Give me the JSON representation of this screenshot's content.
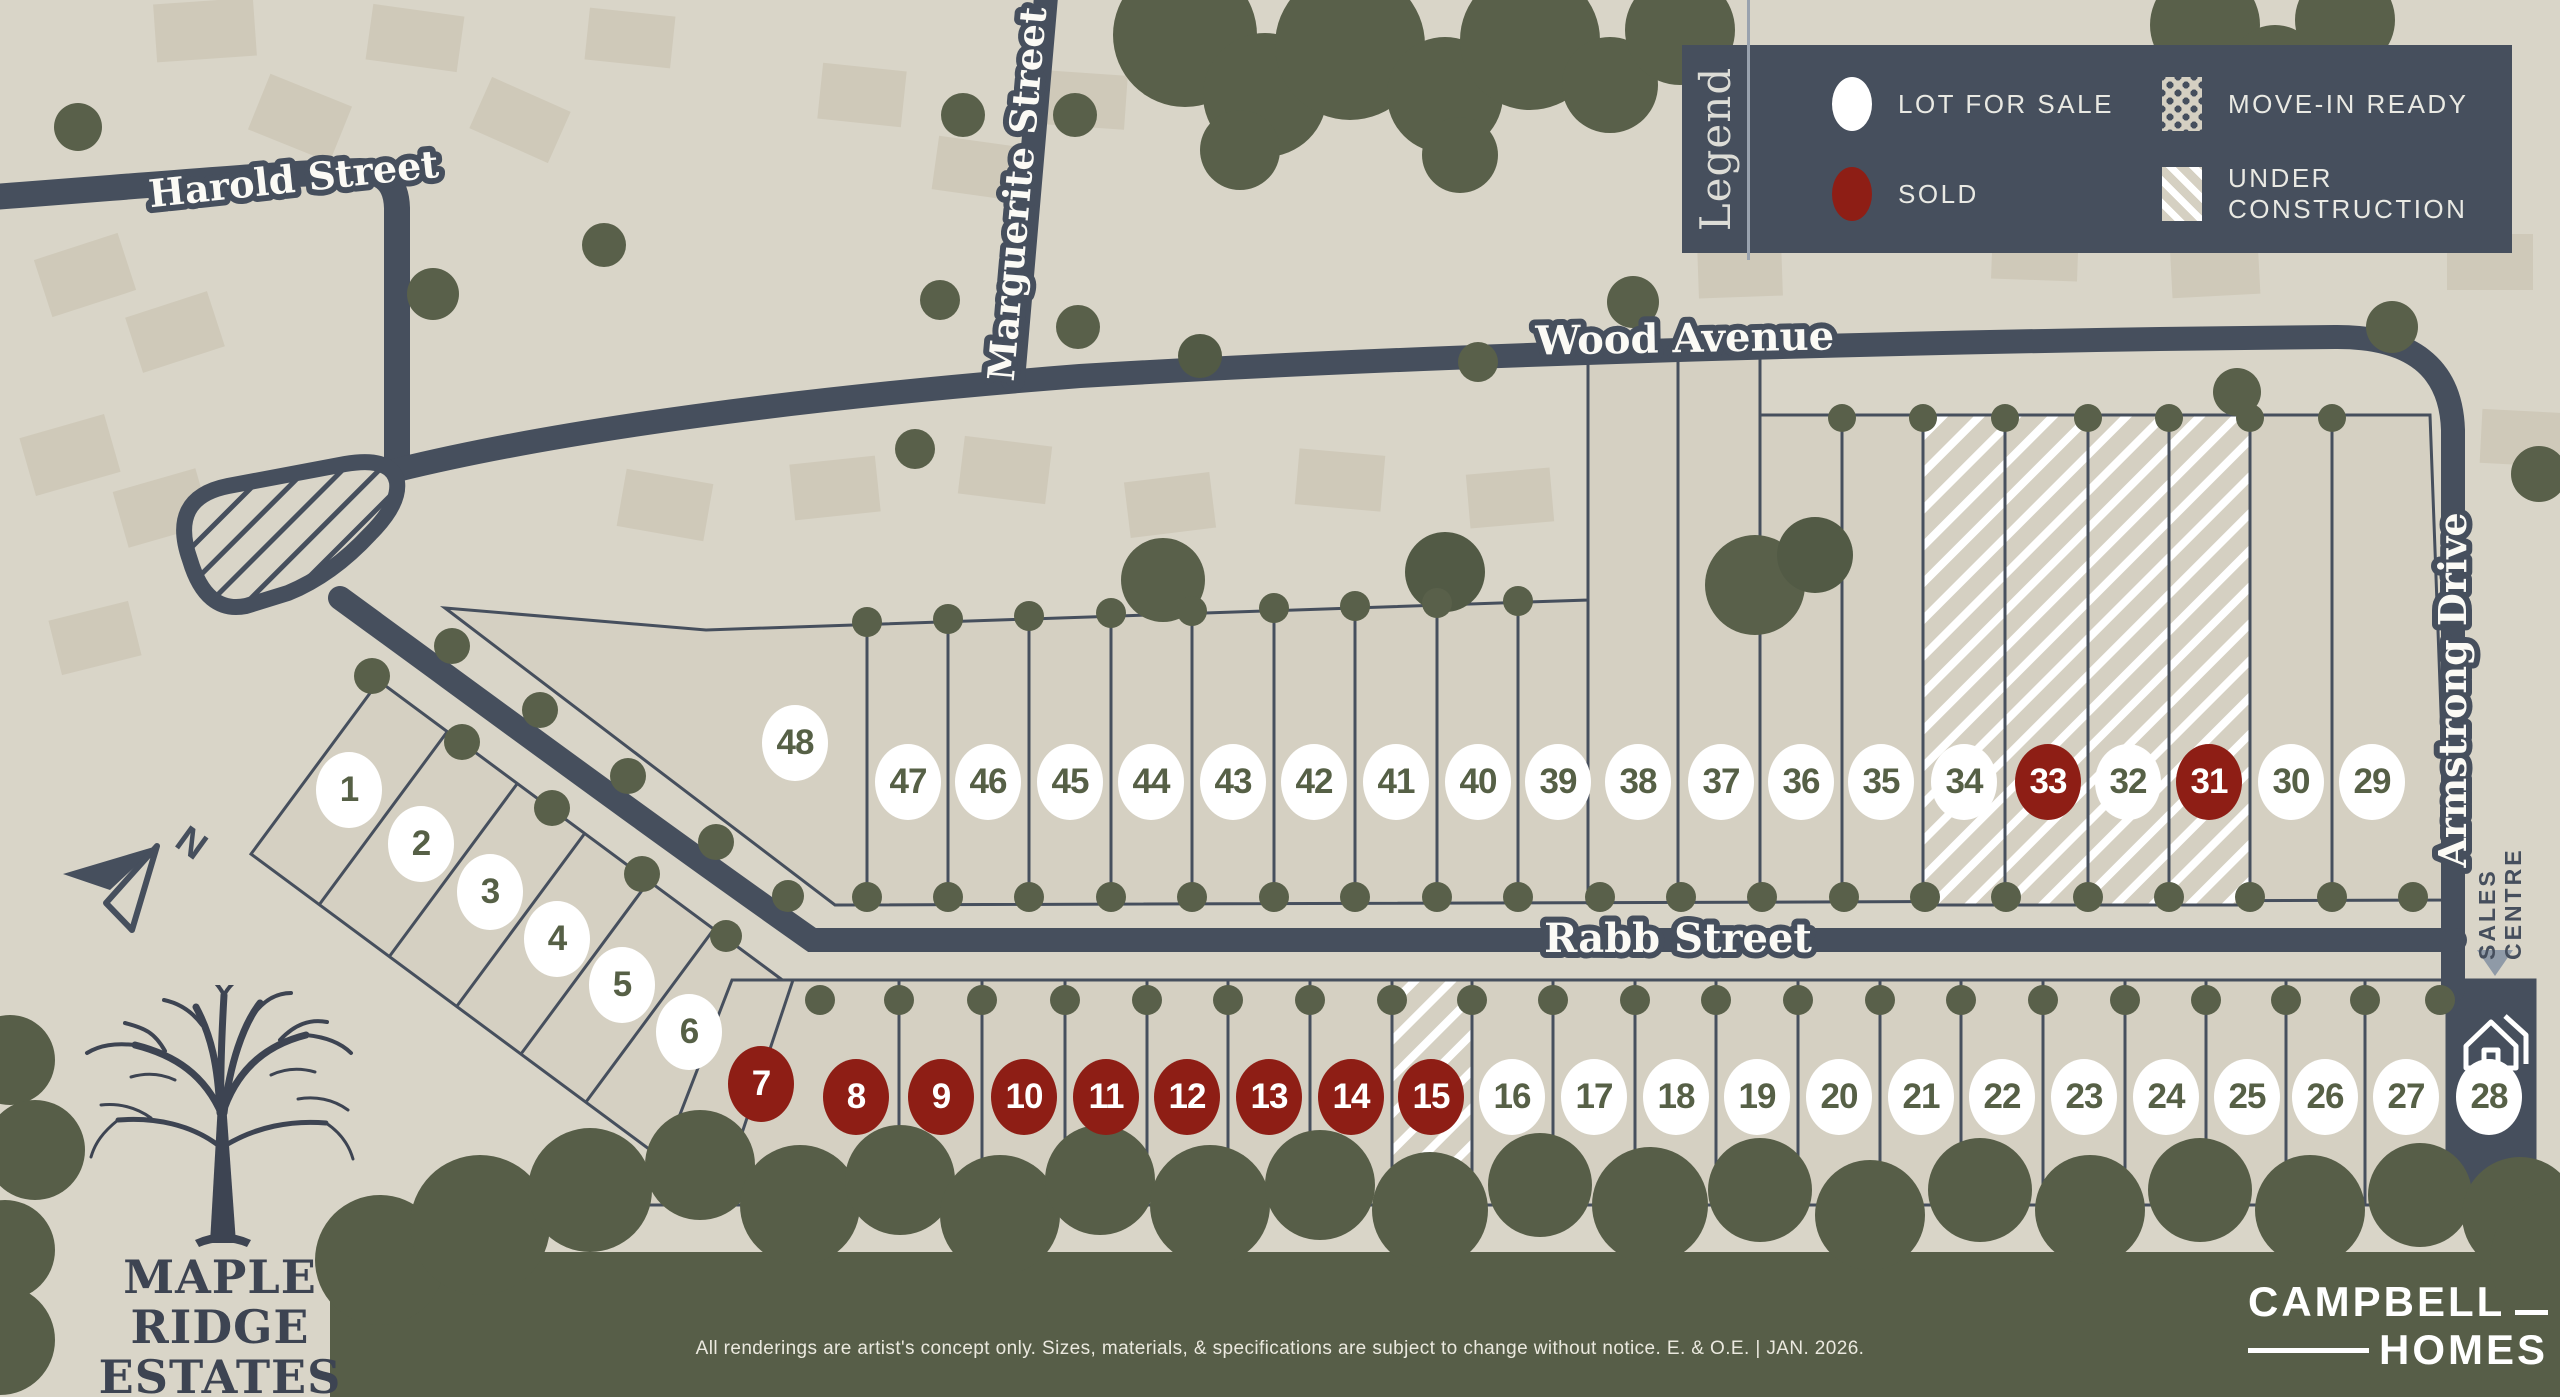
{
  "colors": {
    "road": "#464f5d",
    "sold": "#8e1e15",
    "tree": "#59604a",
    "parcel": "#d5d0c2",
    "background": "#d9d5c8"
  },
  "legend": {
    "title": "Legend",
    "items": [
      {
        "label": "LOT FOR SALE",
        "swatch": "available"
      },
      {
        "label": "SOLD",
        "swatch": "sold"
      },
      {
        "label": "MOVE-IN READY",
        "swatch": "move"
      },
      {
        "label": "UNDER CONSTRUCTION",
        "swatch": "construction"
      }
    ]
  },
  "streets": {
    "harold": "Harold Street",
    "marguerite": "Marguerite Street",
    "wood": "Wood Avenue",
    "rabb": "Rabb Street",
    "armstrong": "Armstrong Drive"
  },
  "compass": {
    "label": "N"
  },
  "sales_centre": {
    "line1": "SALES",
    "line2": "CENTRE"
  },
  "development": {
    "name_line1": "MAPLE RIDGE",
    "name_line2": "ESTATES",
    "location": "SMITHS FALLS"
  },
  "builder": {
    "name_line1": "CAMPBELL",
    "name_line2": "HOMES"
  },
  "disclaimer": "All renderings are artist's concept only. Sizes, materials, & specifications are subject to change without notice. E. & O.E.  |  JAN. 2026.",
  "lots": [
    {
      "number": "1",
      "status": "for_sale"
    },
    {
      "number": "2",
      "status": "for_sale"
    },
    {
      "number": "3",
      "status": "for_sale"
    },
    {
      "number": "4",
      "status": "for_sale"
    },
    {
      "number": "5",
      "status": "for_sale"
    },
    {
      "number": "6",
      "status": "for_sale"
    },
    {
      "number": "7",
      "status": "sold"
    },
    {
      "number": "8",
      "status": "sold"
    },
    {
      "number": "9",
      "status": "sold"
    },
    {
      "number": "10",
      "status": "sold"
    },
    {
      "number": "11",
      "status": "sold"
    },
    {
      "number": "12",
      "status": "sold"
    },
    {
      "number": "13",
      "status": "sold"
    },
    {
      "number": "14",
      "status": "sold"
    },
    {
      "number": "15",
      "status": "sold",
      "parcel": "under_construction"
    },
    {
      "number": "16",
      "status": "for_sale"
    },
    {
      "number": "17",
      "status": "for_sale"
    },
    {
      "number": "18",
      "status": "for_sale"
    },
    {
      "number": "19",
      "status": "for_sale"
    },
    {
      "number": "20",
      "status": "for_sale"
    },
    {
      "number": "21",
      "status": "for_sale"
    },
    {
      "number": "22",
      "status": "for_sale"
    },
    {
      "number": "23",
      "status": "for_sale"
    },
    {
      "number": "24",
      "status": "for_sale"
    },
    {
      "number": "25",
      "status": "for_sale"
    },
    {
      "number": "26",
      "status": "for_sale"
    },
    {
      "number": "27",
      "status": "for_sale"
    },
    {
      "number": "28",
      "status": "for_sale",
      "parcel": "sales_centre"
    },
    {
      "number": "29",
      "status": "for_sale"
    },
    {
      "number": "30",
      "status": "for_sale"
    },
    {
      "number": "31",
      "status": "sold",
      "parcel": "under_construction"
    },
    {
      "number": "32",
      "status": "for_sale",
      "parcel": "under_construction"
    },
    {
      "number": "33",
      "status": "sold",
      "parcel": "under_construction"
    },
    {
      "number": "34",
      "status": "for_sale",
      "parcel": "under_construction"
    },
    {
      "number": "35",
      "status": "for_sale"
    },
    {
      "number": "36",
      "status": "for_sale"
    },
    {
      "number": "37",
      "status": "for_sale"
    },
    {
      "number": "38",
      "status": "for_sale"
    },
    {
      "number": "39",
      "status": "for_sale"
    },
    {
      "number": "40",
      "status": "for_sale"
    },
    {
      "number": "41",
      "status": "for_sale"
    },
    {
      "number": "42",
      "status": "for_sale"
    },
    {
      "number": "43",
      "status": "for_sale"
    },
    {
      "number": "44",
      "status": "for_sale"
    },
    {
      "number": "45",
      "status": "for_sale"
    },
    {
      "number": "46",
      "status": "for_sale"
    },
    {
      "number": "47",
      "status": "for_sale"
    },
    {
      "number": "48",
      "status": "for_sale"
    }
  ]
}
